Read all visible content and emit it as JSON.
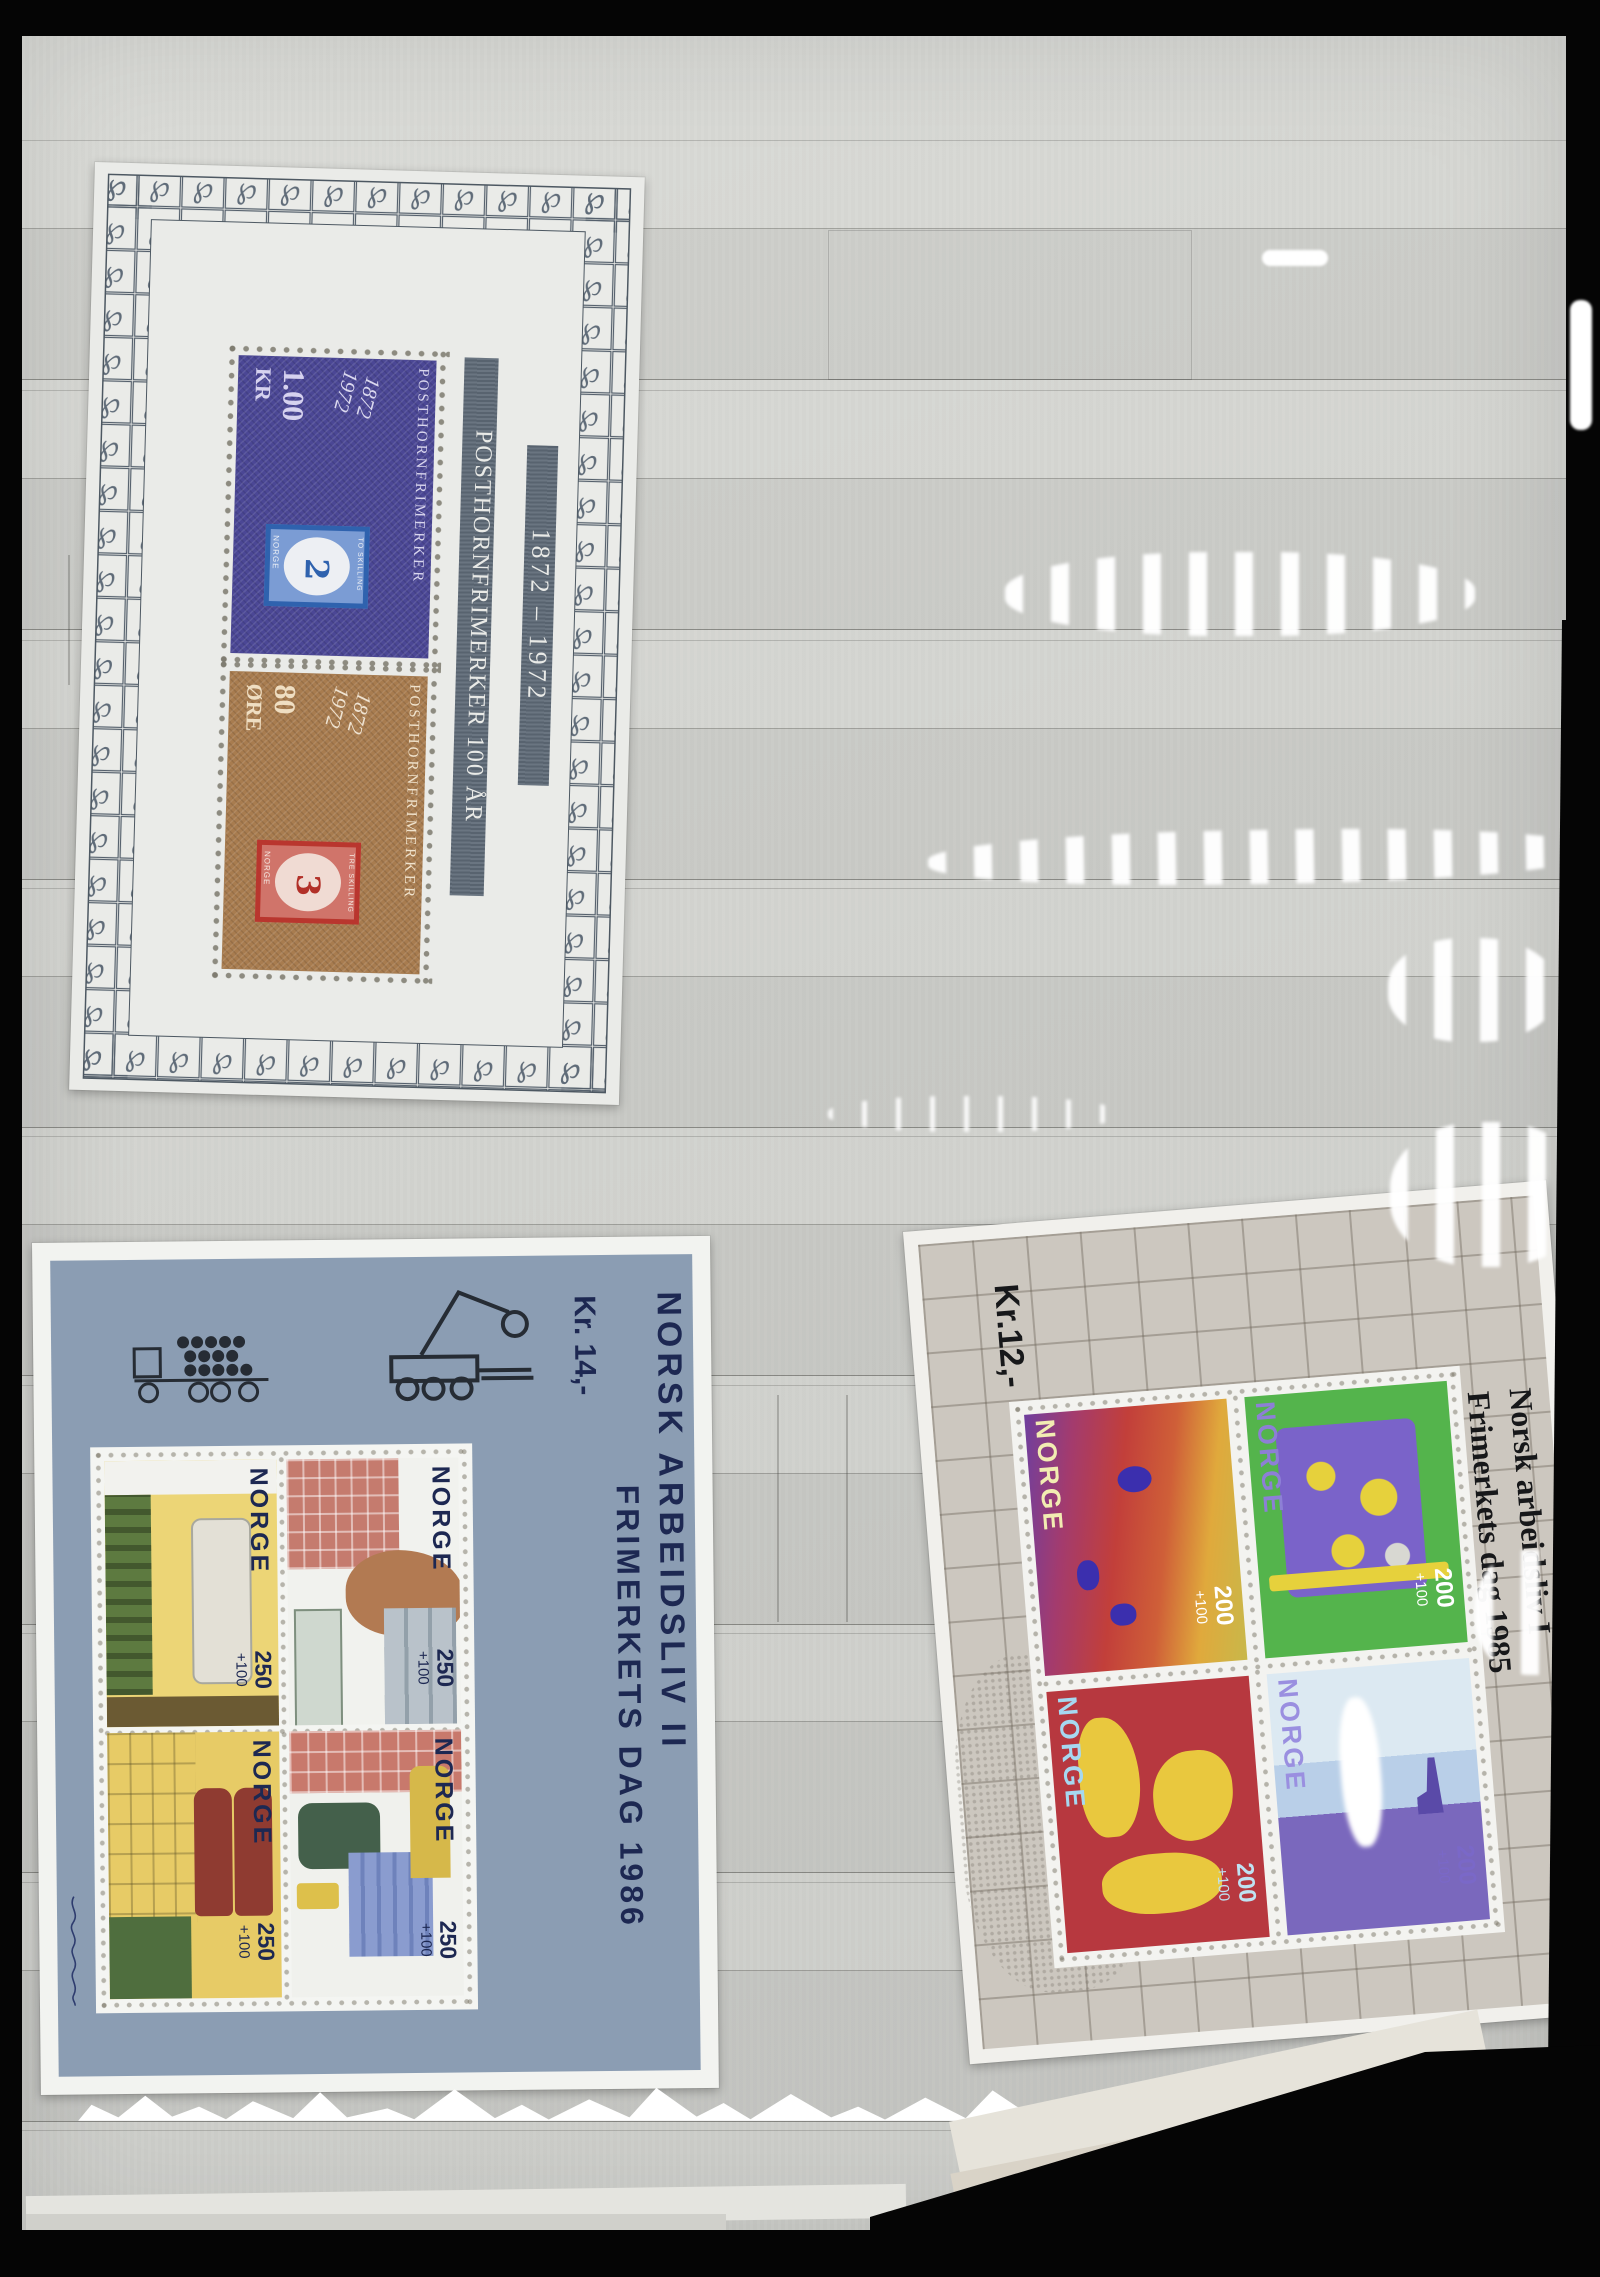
{
  "description": "Photograph of a stockbook album page holding three Norwegian souvenir sheets",
  "sheets": {
    "posthorn_1972": {
      "band_title": "POSTHORNFRIMERKER 100 ÅR",
      "band_years": "1872 – 1972",
      "stamps": [
        {
          "value": "1.00",
          "unit": "KR",
          "year1": "1872",
          "year2": "1972",
          "caption": "POSTHORNFRIMERKER",
          "inner": {
            "country": "NORGE",
            "numeral": "2",
            "denomination": "TO SKILLING"
          }
        },
        {
          "value": "80",
          "unit": "ØRE",
          "year1": "1872",
          "year2": "1972",
          "caption": "POSTHORNFRIMERKER",
          "inner": {
            "country": "NORGE",
            "numeral": "3",
            "denomination": "TRE SKILLING"
          }
        }
      ]
    },
    "arbeidsliv_ii_1986": {
      "price": "Kr. 14,-",
      "title": "NORSK ARBEIDSLIV II",
      "subtitle": "FRIMERKETS DAG 1986",
      "country": "NORGE",
      "value": "250",
      "surcharge": "+100",
      "signature": "(handwritten artist signature in margin)"
    },
    "arbeidsliv_i_1985": {
      "price": "Kr.12,-",
      "title": "Norsk arbeidsliv I",
      "subtitle": "Frimerkets dag 1985",
      "country": "NORGE",
      "value": "200",
      "surcharge": "+100"
    }
  },
  "colors": {
    "album_page": "#d2d3cf",
    "backdrop": "#050505",
    "sheet72_paper": "#eaebe8",
    "sheet72_band": "#5d6976",
    "stamp_1kr_blue": "#4b4795",
    "stamp_80ore_brown": "#a87c4f",
    "inner_2sk_blue": "#2f62ae",
    "inner_3sk_red": "#b9362e",
    "sheet86_field": "#8b9db3",
    "sheet86_text_navy": "#1d2852",
    "sheet85_field": "#ccc7bf",
    "sheet85_text": "#17181a"
  },
  "decor": {
    "border_motif": "posthorn ornament squares",
    "page_motifs": "plastic pocket strips with glare",
    "sheet85_motifs": "grid pattern and dotted map of Norway"
  }
}
